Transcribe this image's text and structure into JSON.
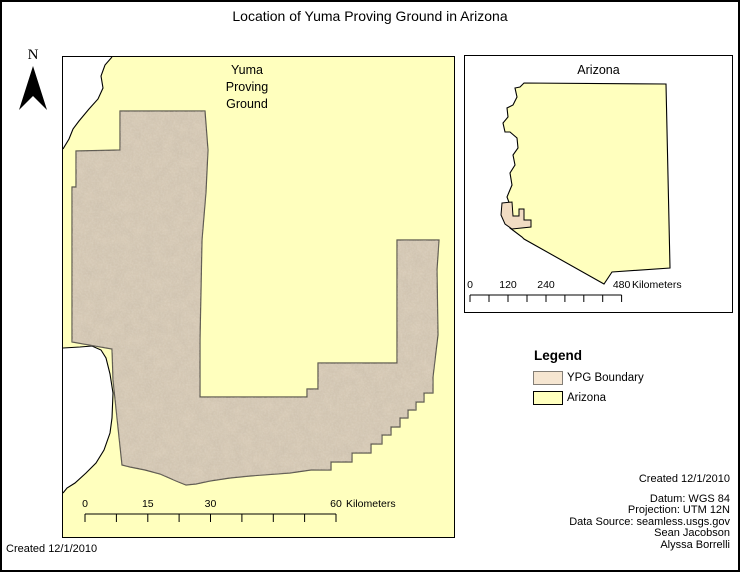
{
  "title": "Location of Yuma Proving Ground in Arizona",
  "north_arrow": {
    "label": "N"
  },
  "main_map": {
    "area_label_lines": [
      "Yuma",
      "Proving",
      "Ground"
    ],
    "scalebar": {
      "labels": [
        "0",
        "15",
        "30",
        "60"
      ],
      "unit": "Kilometers"
    }
  },
  "inset_map": {
    "title": "Arizona",
    "scalebar": {
      "labels": [
        "0",
        "120",
        "240",
        "480"
      ],
      "unit": "Kilometers"
    }
  },
  "legend": {
    "title": "Legend",
    "items": [
      {
        "label": "YPG Boundary",
        "color": "#F6E6D1",
        "border": "#837E77"
      },
      {
        "label": "Arizona",
        "color": "#FFFFBE",
        "border": "#000000"
      }
    ]
  },
  "credits": {
    "created": "Created 12/1/2010",
    "lines": [
      "Datum: WGS 84",
      "Projection: UTM 12N",
      "Data Source: seamless.usgs.gov",
      "Sean Jacobson",
      "Alyssa Borrelli"
    ]
  },
  "footer": {
    "created": "Created 12/1/2010"
  },
  "colors": {
    "arizona_fill": "#FFFFBE",
    "ypg_fill": "#D6C9B5",
    "ypg_outline": "#57534B",
    "outside_fill": "#FFFFFF",
    "boundary_line": "#000000",
    "inset_ypg_fill": "#F1DCC3"
  }
}
